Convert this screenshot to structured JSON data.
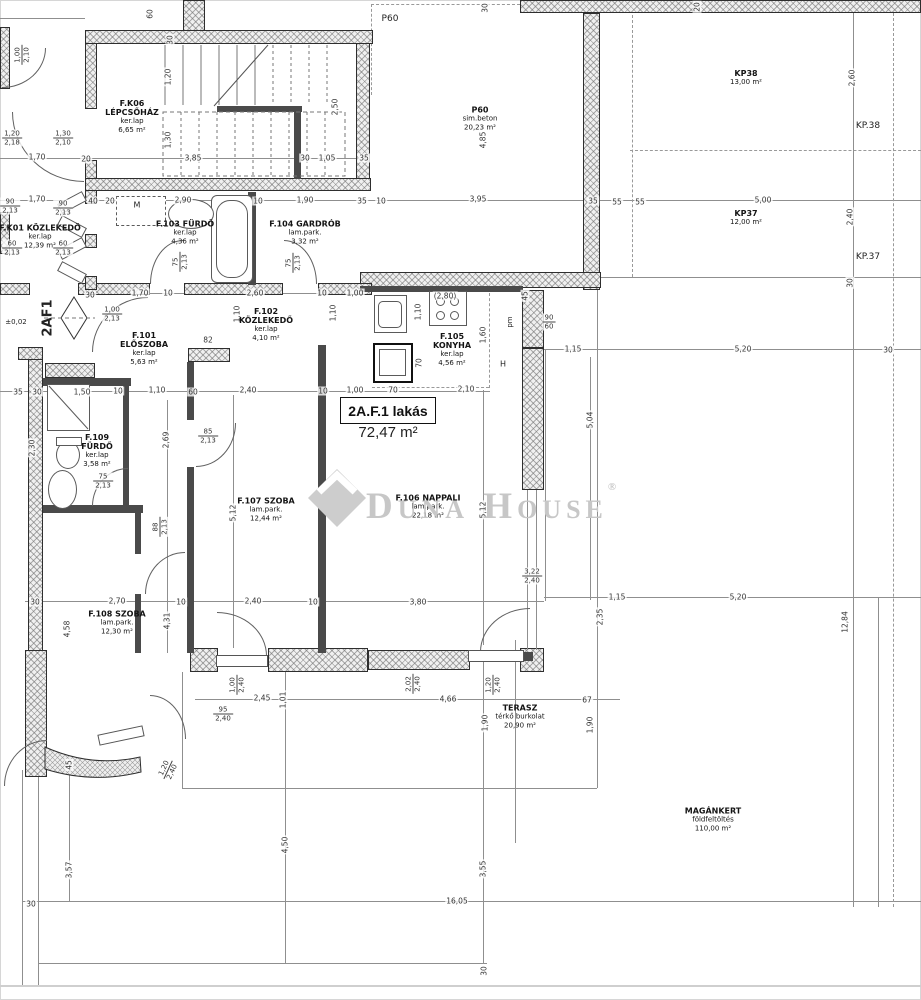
{
  "apartment": {
    "label": "2A.F.1 lakás",
    "area": "72,47 m²"
  },
  "watermark": {
    "text": "Duna House",
    "reg": "®"
  },
  "rooms": [
    {
      "id": "FK06",
      "x": 132,
      "y": 117,
      "lines": [
        {
          "t": "F.K06",
          "b": 1
        },
        {
          "t": "LÉPCSŐHÁZ",
          "b": 1
        },
        {
          "t": "ker.lap"
        },
        {
          "t": "6,65 m²"
        }
      ]
    },
    {
      "id": "FK01",
      "x": 40,
      "y": 237,
      "lines": [
        {
          "t": "F.K01 KÖZLEKEDŐ",
          "b": 1
        },
        {
          "t": "ker.lap"
        },
        {
          "t": "12,39 m²"
        }
      ]
    },
    {
      "id": "F101",
      "x": 144,
      "y": 349,
      "lines": [
        {
          "t": "F.101",
          "b": 1
        },
        {
          "t": "ELŐSZOBA",
          "b": 1
        },
        {
          "t": "ker.lap"
        },
        {
          "t": "5,63 m²"
        }
      ]
    },
    {
      "id": "F102",
      "x": 266,
      "y": 325,
      "lines": [
        {
          "t": "F.102",
          "b": 1
        },
        {
          "t": "KÖZLEKEDŐ",
          "b": 1
        },
        {
          "t": "ker.lap"
        },
        {
          "t": "4,10 m²"
        }
      ]
    },
    {
      "id": "F103",
      "x": 185,
      "y": 233,
      "lines": [
        {
          "t": "F.103 FÜRDŐ",
          "b": 1
        },
        {
          "t": "ker.lap"
        },
        {
          "t": "4,36 m²"
        }
      ]
    },
    {
      "id": "F104",
      "x": 305,
      "y": 233,
      "lines": [
        {
          "t": "F.104 GARDRÓB",
          "b": 1
        },
        {
          "t": "lam.park."
        },
        {
          "t": "3,32 m²"
        }
      ]
    },
    {
      "id": "F105",
      "x": 452,
      "y": 350,
      "lines": [
        {
          "t": "F.105",
          "b": 1
        },
        {
          "t": "KONYHA",
          "b": 1
        },
        {
          "t": "ker.lap"
        },
        {
          "t": "4,56 m²"
        }
      ]
    },
    {
      "id": "F106",
      "x": 428,
      "y": 507,
      "lines": [
        {
          "t": "F.106 NAPPALI",
          "b": 1
        },
        {
          "t": "lam.park."
        },
        {
          "t": "22,18 m²"
        }
      ]
    },
    {
      "id": "F107",
      "x": 266,
      "y": 510,
      "lines": [
        {
          "t": "F.107 SZOBA",
          "b": 1
        },
        {
          "t": "lam.park."
        },
        {
          "t": "12,44 m²"
        }
      ]
    },
    {
      "id": "F108",
      "x": 117,
      "y": 623,
      "lines": [
        {
          "t": "F.108 SZOBA",
          "b": 1
        },
        {
          "t": "lam.park."
        },
        {
          "t": "12,30 m²"
        }
      ]
    },
    {
      "id": "F109",
      "x": 97,
      "y": 451,
      "lines": [
        {
          "t": "F.109",
          "b": 1
        },
        {
          "t": "FÜRDŐ",
          "b": 1
        },
        {
          "t": "ker.lap"
        },
        {
          "t": "3,58 m²"
        }
      ]
    },
    {
      "id": "P60",
      "x": 480,
      "y": 119,
      "lines": [
        {
          "t": "P60",
          "b": 1
        },
        {
          "t": "sim.beton"
        },
        {
          "t": "20,23 m²"
        }
      ]
    },
    {
      "id": "KP38",
      "x": 746,
      "y": 78,
      "lines": [
        {
          "t": "KP38",
          "b": 1
        },
        {
          "t": "13,00 m²"
        }
      ]
    },
    {
      "id": "KP37",
      "x": 746,
      "y": 218,
      "lines": [
        {
          "t": "KP37",
          "b": 1
        },
        {
          "t": "12,00 m²"
        }
      ]
    },
    {
      "id": "TERASZ",
      "x": 520,
      "y": 717,
      "lines": [
        {
          "t": "TERASZ",
          "b": 1
        },
        {
          "t": "térkő burkolat"
        },
        {
          "t": "20,90 m²"
        }
      ]
    },
    {
      "id": "MAGANKERT",
      "x": 713,
      "y": 820,
      "lines": [
        {
          "t": "MAGÁNKERT",
          "b": 1
        },
        {
          "t": "földfeltöltés"
        },
        {
          "t": "110,00 m²"
        }
      ]
    }
  ],
  "markers": [
    {
      "t": "P60",
      "x": 390,
      "y": 19,
      "s": 9
    },
    {
      "t": "KP.38",
      "x": 868,
      "y": 126,
      "s": 9
    },
    {
      "t": "KP.37",
      "x": 868,
      "y": 257,
      "s": 9
    },
    {
      "t": "2AF1",
      "x": 48,
      "y": 318,
      "r": 1,
      "b": 1,
      "s": 13
    },
    {
      "t": "±0,02",
      "x": 16,
      "y": 322,
      "s": 7
    },
    {
      "t": "M",
      "x": 137,
      "y": 205,
      "s": 8
    },
    {
      "t": "H",
      "x": 503,
      "y": 364,
      "s": 8
    },
    {
      "t": "pm",
      "x": 510,
      "y": 322,
      "r": 1,
      "s": 7
    }
  ],
  "dims": [
    {
      "t": "60",
      "x": 150,
      "y": 14,
      "r": 1
    },
    {
      "t": "30",
      "x": 170,
      "y": 40,
      "r": 1
    },
    {
      "t": "1,20",
      "x": 168,
      "y": 77,
      "r": 1
    },
    {
      "t": "1,30",
      "x": 168,
      "y": 140,
      "r": 1
    },
    {
      "t": "2,50",
      "x": 335,
      "y": 107,
      "r": 1
    },
    {
      "t": "30",
      "x": 485,
      "y": 8,
      "r": 1
    },
    {
      "t": "20",
      "x": 697,
      "y": 7,
      "r": 1
    },
    {
      "t": "2,60",
      "x": 852,
      "y": 78,
      "r": 1
    },
    {
      "t": "4,85",
      "x": 483,
      "y": 140,
      "r": 1
    },
    {
      "t": "2,40",
      "x": 850,
      "y": 217,
      "r": 1
    },
    {
      "t": "1,70",
      "x": 37,
      "y": 157
    },
    {
      "t": "20",
      "x": 86,
      "y": 159
    },
    {
      "t": "3,85",
      "x": 193,
      "y": 158
    },
    {
      "t": "30",
      "x": 305,
      "y": 158
    },
    {
      "t": "1,05",
      "x": 327,
      "y": 158
    },
    {
      "t": "35",
      "x": 364,
      "y": 158
    },
    {
      "t": "1,70",
      "x": 37,
      "y": 199
    },
    {
      "t": "40",
      "x": 93,
      "y": 201
    },
    {
      "t": "20",
      "x": 110,
      "y": 201
    },
    {
      "t": "2,90",
      "x": 183,
      "y": 200
    },
    {
      "t": "10",
      "x": 258,
      "y": 201
    },
    {
      "t": "1,90",
      "x": 305,
      "y": 200
    },
    {
      "t": "35",
      "x": 362,
      "y": 201
    },
    {
      "t": "10",
      "x": 381,
      "y": 201
    },
    {
      "t": "3,95",
      "x": 478,
      "y": 199
    },
    {
      "t": "35",
      "x": 593,
      "y": 201
    },
    {
      "t": "55",
      "x": 617,
      "y": 202
    },
    {
      "t": "55",
      "x": 640,
      "y": 202
    },
    {
      "t": "5,00",
      "x": 763,
      "y": 200
    },
    {
      "t": "30",
      "x": 90,
      "y": 295
    },
    {
      "t": "1,70",
      "x": 140,
      "y": 293
    },
    {
      "t": "10",
      "x": 168,
      "y": 293
    },
    {
      "t": "2,60",
      "x": 255,
      "y": 293
    },
    {
      "t": "10",
      "x": 322,
      "y": 293
    },
    {
      "t": "1,00",
      "x": 355,
      "y": 293
    },
    {
      "t": "(2,80)",
      "x": 445,
      "y": 296
    },
    {
      "t": "1,10",
      "x": 237,
      "y": 314,
      "r": 1
    },
    {
      "t": "1,10",
      "x": 333,
      "y": 313,
      "r": 1
    },
    {
      "t": "1,10",
      "x": 418,
      "y": 312,
      "r": 1
    },
    {
      "t": "1,60",
      "x": 483,
      "y": 335,
      "r": 1
    },
    {
      "t": "45",
      "x": 525,
      "y": 296,
      "r": 1
    },
    {
      "t": "82",
      "x": 208,
      "y": 340
    },
    {
      "t": "70",
      "x": 419,
      "y": 363,
      "r": 1
    },
    {
      "t": "35",
      "x": 18,
      "y": 392
    },
    {
      "t": "30",
      "x": 37,
      "y": 392
    },
    {
      "t": "1,50",
      "x": 82,
      "y": 392
    },
    {
      "t": "10",
      "x": 118,
      "y": 391
    },
    {
      "t": "1,10",
      "x": 157,
      "y": 390
    },
    {
      "t": "60",
      "x": 193,
      "y": 392
    },
    {
      "t": "2,40",
      "x": 248,
      "y": 390
    },
    {
      "t": "10",
      "x": 323,
      "y": 391
    },
    {
      "t": "1,00",
      "x": 355,
      "y": 390
    },
    {
      "t": "70",
      "x": 393,
      "y": 390
    },
    {
      "t": "2,10",
      "x": 466,
      "y": 389
    },
    {
      "t": "1,15",
      "x": 573,
      "y": 349
    },
    {
      "t": "5,20",
      "x": 743,
      "y": 349
    },
    {
      "t": "30",
      "x": 888,
      "y": 350
    },
    {
      "t": "30",
      "x": 850,
      "y": 283,
      "r": 1
    },
    {
      "t": "5,04",
      "x": 590,
      "y": 420,
      "r": 1
    },
    {
      "t": "2,69",
      "x": 166,
      "y": 440,
      "r": 1
    },
    {
      "t": "2,30",
      "x": 32,
      "y": 448,
      "r": 1
    },
    {
      "t": "5,12",
      "x": 233,
      "y": 513,
      "r": 1
    },
    {
      "t": "5,12",
      "x": 483,
      "y": 510,
      "r": 1
    },
    {
      "t": "4,31",
      "x": 167,
      "y": 621,
      "r": 1
    },
    {
      "t": "4,58",
      "x": 67,
      "y": 629,
      "r": 1
    },
    {
      "t": "30",
      "x": 35,
      "y": 602
    },
    {
      "t": "2,70",
      "x": 117,
      "y": 601
    },
    {
      "t": "10",
      "x": 181,
      "y": 602
    },
    {
      "t": "2,40",
      "x": 253,
      "y": 601
    },
    {
      "t": "10",
      "x": 313,
      "y": 602
    },
    {
      "t": "3,80",
      "x": 418,
      "y": 602
    },
    {
      "t": "1,15",
      "x": 617,
      "y": 597
    },
    {
      "t": "5,20",
      "x": 738,
      "y": 597
    },
    {
      "t": "2,35",
      "x": 600,
      "y": 617,
      "r": 1
    },
    {
      "t": "12,84",
      "x": 845,
      "y": 622,
      "r": 1
    },
    {
      "t": "2,45",
      "x": 262,
      "y": 698
    },
    {
      "t": "1,01",
      "x": 283,
      "y": 700,
      "r": 1
    },
    {
      "t": "4,66",
      "x": 448,
      "y": 699
    },
    {
      "t": "67",
      "x": 587,
      "y": 700
    },
    {
      "t": "1,90",
      "x": 485,
      "y": 723,
      "r": 1
    },
    {
      "t": "1,90",
      "x": 590,
      "y": 725,
      "r": 1
    },
    {
      "t": "45",
      "x": 69,
      "y": 765,
      "r": 1
    },
    {
      "t": "3,57",
      "x": 69,
      "y": 870,
      "r": 1
    },
    {
      "t": "4,50",
      "x": 285,
      "y": 845,
      "r": 1
    },
    {
      "t": "3,55",
      "x": 483,
      "y": 869,
      "r": 1
    },
    {
      "t": "16,05",
      "x": 457,
      "y": 901
    },
    {
      "t": "30",
      "x": 31,
      "y": 904
    },
    {
      "t": "30",
      "x": 484,
      "y": 971,
      "r": 1
    }
  ],
  "fracs": [
    {
      "a": "1,00",
      "b": "2,10",
      "x": 22,
      "y": 55,
      "r": 1
    },
    {
      "a": "1,20",
      "b": "2,18",
      "x": 12,
      "y": 138
    },
    {
      "a": "1,30",
      "b": "2,10",
      "x": 63,
      "y": 138
    },
    {
      "a": "90",
      "b": "2,13",
      "x": 10,
      "y": 206
    },
    {
      "a": "90",
      "b": "2,13",
      "x": 63,
      "y": 208
    },
    {
      "a": "60",
      "b": "2,13",
      "x": 12,
      "y": 248
    },
    {
      "a": "60",
      "b": "2,13",
      "x": 63,
      "y": 248
    },
    {
      "a": "1,00",
      "b": "2,13",
      "x": 112,
      "y": 314
    },
    {
      "a": "75",
      "b": "2,13",
      "x": 180,
      "y": 262,
      "r": 1
    },
    {
      "a": "75",
      "b": "2,13",
      "x": 293,
      "y": 263,
      "r": 1
    },
    {
      "a": "75",
      "b": "2,13",
      "x": 103,
      "y": 481
    },
    {
      "a": "85",
      "b": "2,13",
      "x": 208,
      "y": 436
    },
    {
      "a": "88",
      "b": "2,13",
      "x": 160,
      "y": 527,
      "r": 1
    },
    {
      "a": "90",
      "b": "60",
      "x": 549,
      "y": 322
    },
    {
      "a": "1,00",
      "b": "2,40",
      "x": 237,
      "y": 685,
      "r": 1
    },
    {
      "a": "2,02",
      "b": "2,40",
      "x": 413,
      "y": 684,
      "r": 1
    },
    {
      "a": "1,20",
      "b": "2,40",
      "x": 493,
      "y": 685,
      "r": 1
    },
    {
      "a": "95",
      "b": "2,40",
      "x": 223,
      "y": 714
    },
    {
      "a": "3,22",
      "b": "2,40",
      "x": 532,
      "y": 576
    },
    {
      "a": "1,20",
      "b": "2,40",
      "x": 168,
      "y": 770,
      "d": 1
    }
  ]
}
